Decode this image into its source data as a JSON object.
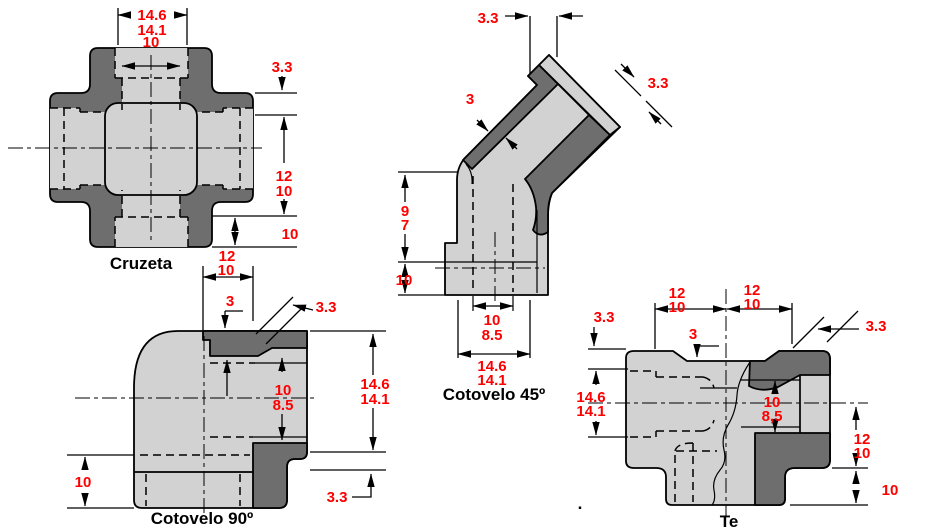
{
  "colors": {
    "body_light": "#d2d2d2",
    "wall_dark": "#6e6e6e",
    "outline": "#000000",
    "dimension_text": "#ff0000",
    "background": "#ffffff"
  },
  "fittings": {
    "cruzeta": {
      "label": "Cruzeta",
      "dims": {
        "outer_dia_max": "14.6",
        "outer_dia_min": "14.1",
        "bore_dia": "10",
        "end_wall": "3.3",
        "socket_depth_max": "12",
        "socket_depth_min": "10",
        "thread_depth": "10"
      }
    },
    "cotovelo45": {
      "label": "Cotovelo 45º",
      "dims": {
        "end_wall": "3.3",
        "flange_wall": "3.3",
        "wall_thickness": "3",
        "body_height_max": "9",
        "body_height_min": "7",
        "socket_depth": "10",
        "bore_max": "10",
        "bore_min": "8.5",
        "width_max": "14.6",
        "width_min": "14.1"
      }
    },
    "cotovelo90": {
      "label": "Cotovelo 90º",
      "dims": {
        "top_socket_max": "12",
        "top_socket_min": "10",
        "top_wall": "3",
        "top_chamfer": "3.3",
        "bore_max": "10",
        "bore_min": "8.5",
        "height_max": "14.6",
        "height_min": "14.1",
        "bottom_chamfer": "3.3",
        "left_socket_depth": "10"
      }
    },
    "te": {
      "label": "Te",
      "stray_dot": ".",
      "dims": {
        "left_wall": "3.3",
        "left_socket_max": "12",
        "left_socket_min": "10",
        "right_socket_max": "12",
        "right_socket_min": "10",
        "center_wall": "3",
        "chamfer": "3.3",
        "left_dia_max": "14.6",
        "left_dia_min": "14.1",
        "bore_max": "10",
        "bore_min": "8,5",
        "right_depth_max": "12",
        "right_depth_min": "10",
        "thread_depth": "10"
      }
    }
  }
}
